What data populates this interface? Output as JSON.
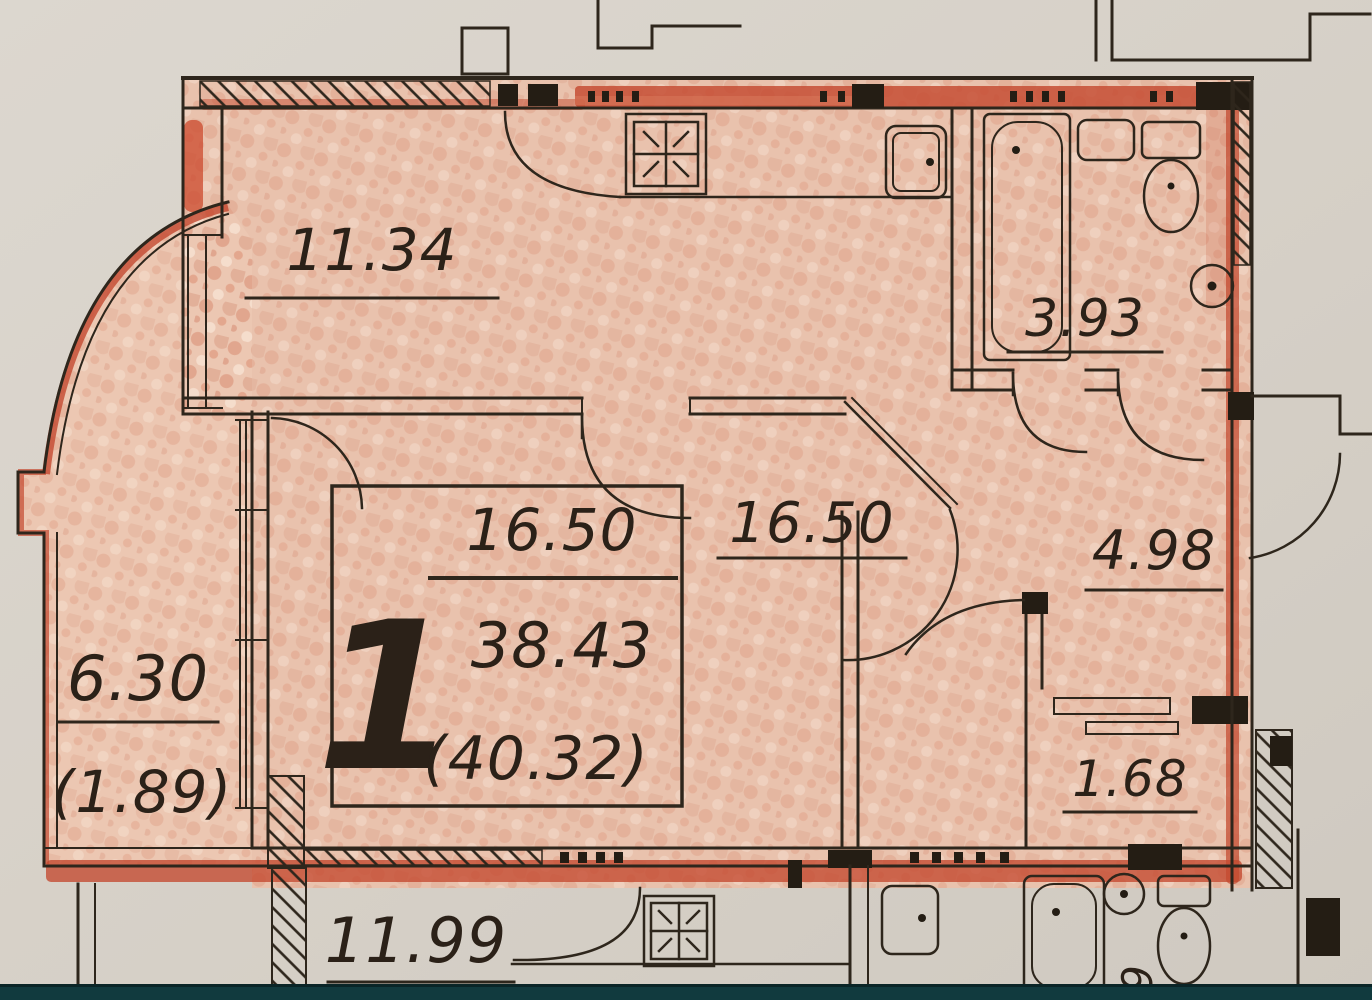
{
  "rooms": {
    "kitchen": {
      "area": "11.34"
    },
    "bathroom": {
      "area": "3.93"
    },
    "living_room": {
      "area": "16.50"
    },
    "hallway": {
      "area": "4.98"
    },
    "storage": {
      "area": "1.68"
    },
    "balcony": {
      "area": "6.30",
      "area_coefficient": "(1.89)"
    },
    "neighbor_room": {
      "area": "11.99",
      "side_glyph": "9"
    }
  },
  "stamp": {
    "rooms_count": "1",
    "living_area": "16.50",
    "total_area": "38.43",
    "total_area_with_balcony": "(40.32)"
  },
  "palette": {
    "paper": "#d8d2c9",
    "floor_fill": "#e9c2ad",
    "crayon_red": "#c4492f",
    "ink": "#2e261c",
    "footer_bar": "#113a3e"
  }
}
